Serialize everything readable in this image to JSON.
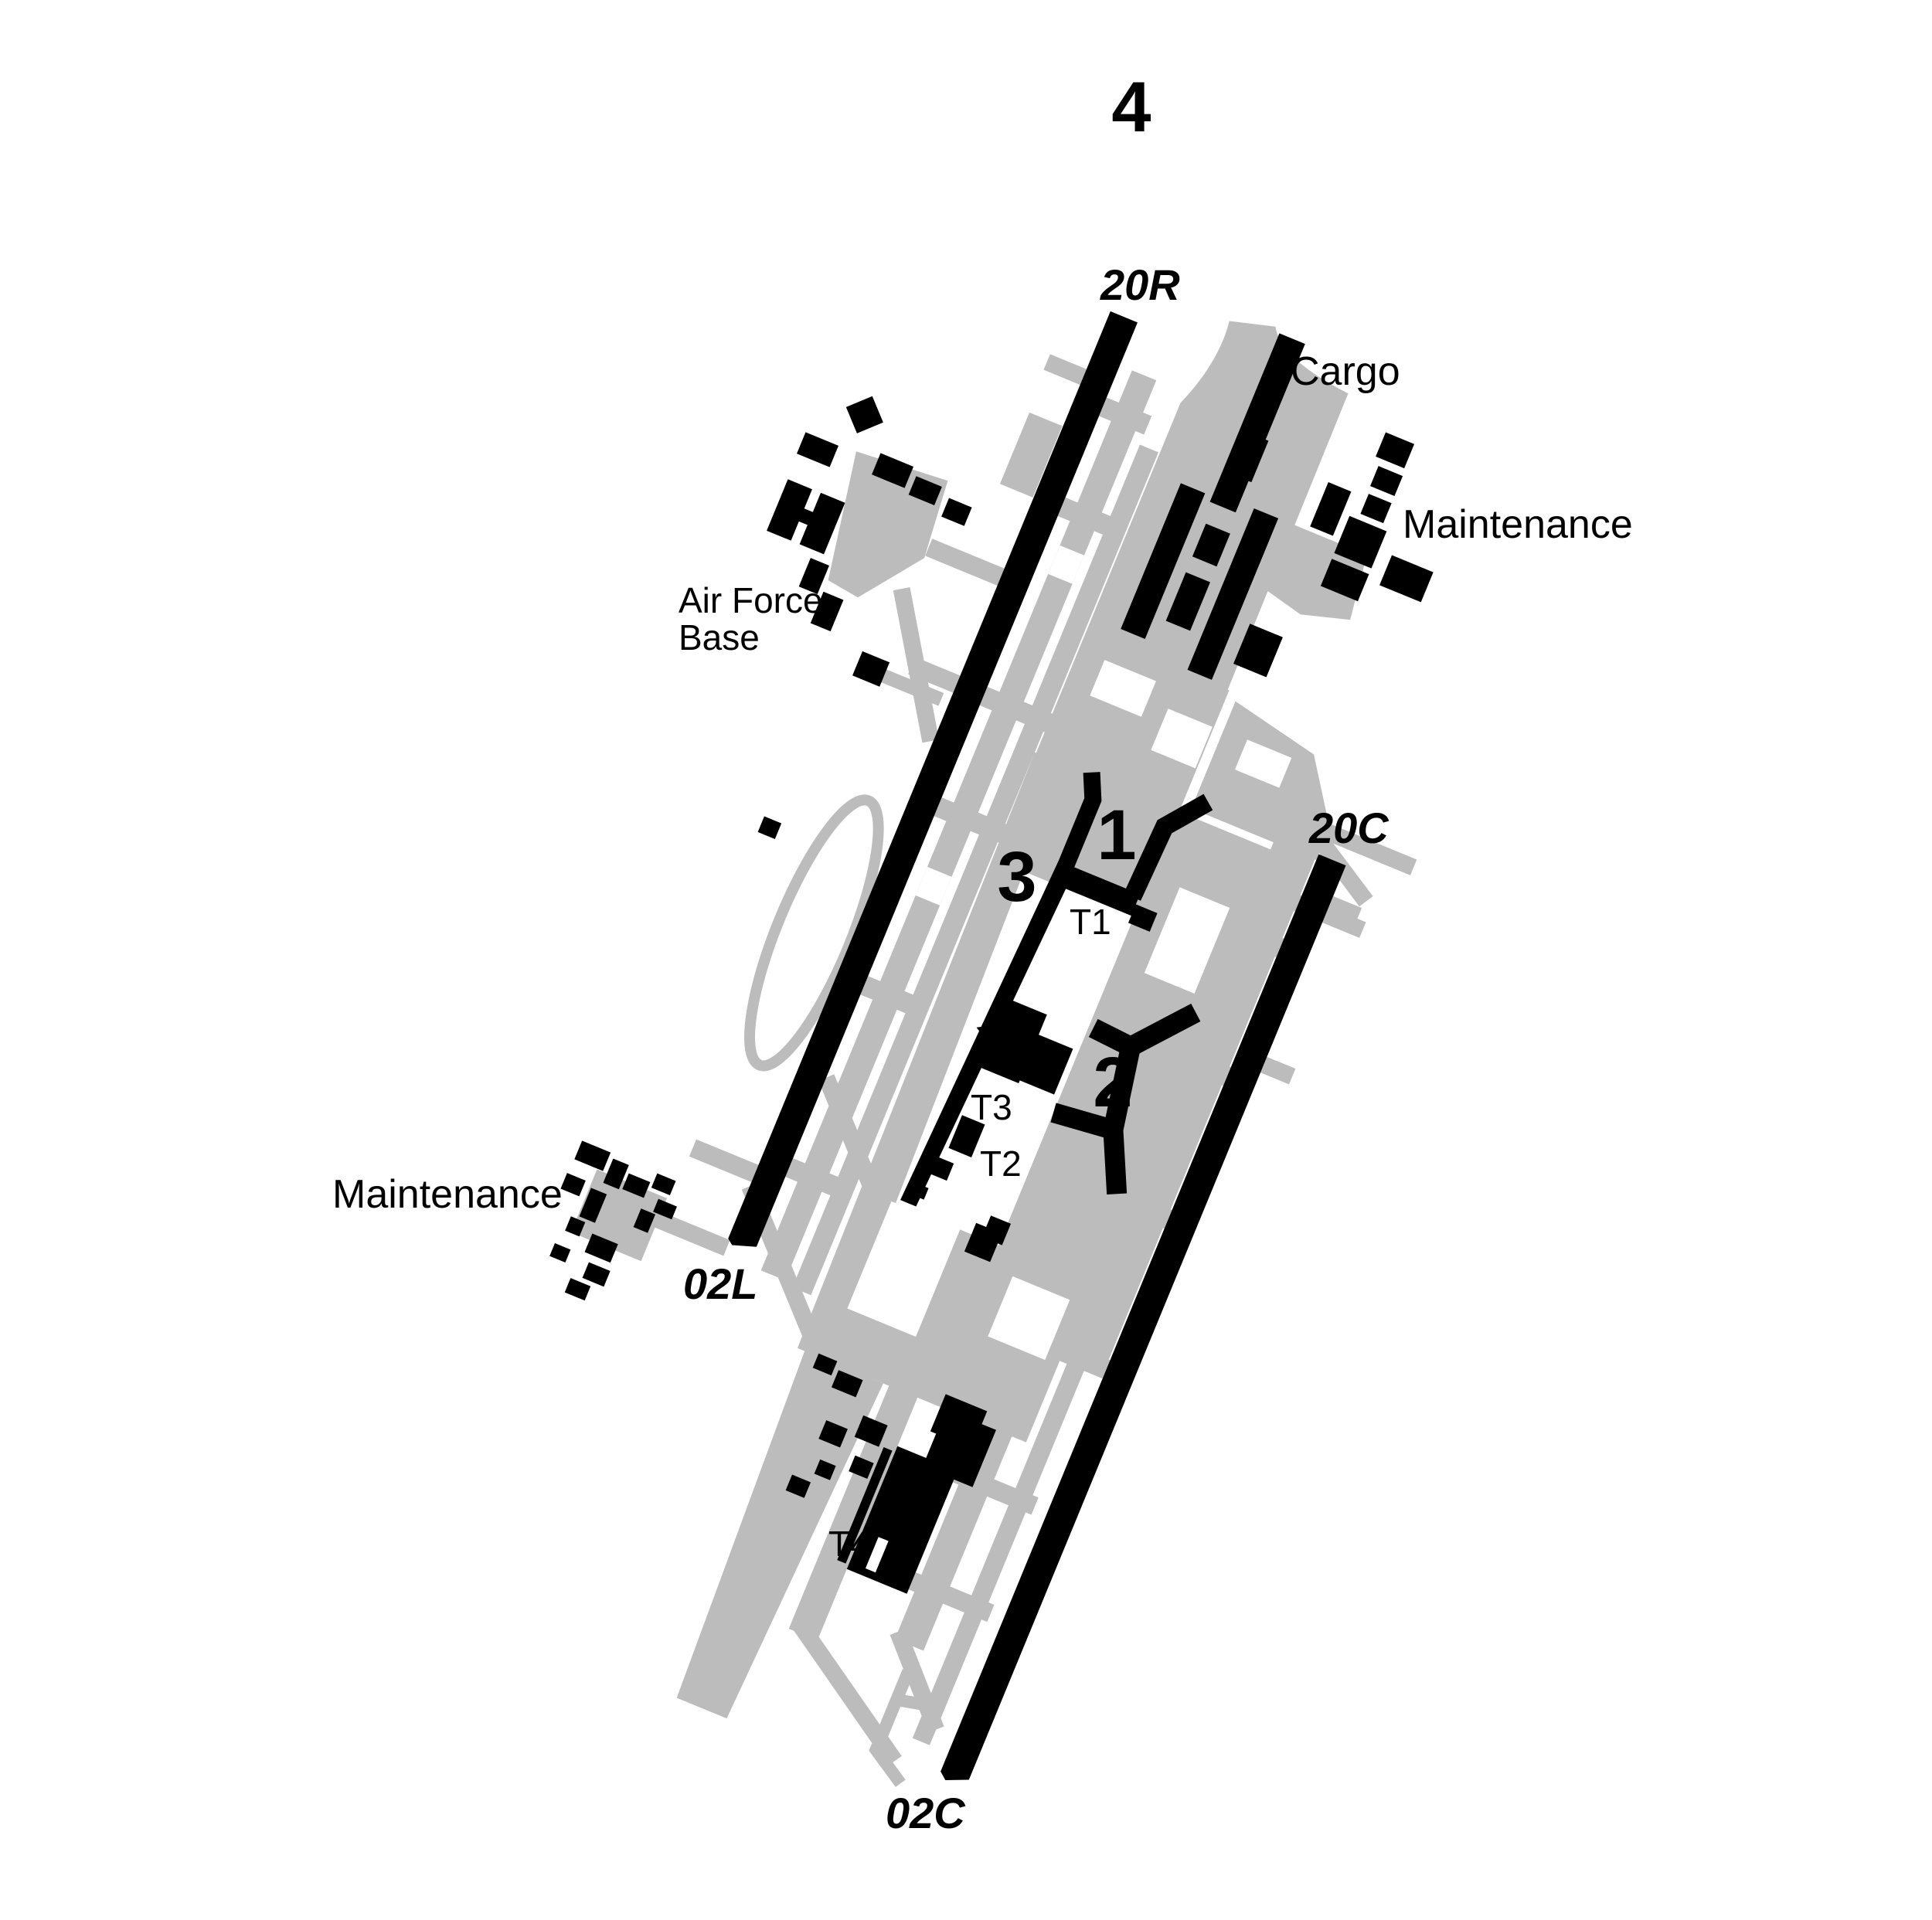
{
  "figure": {
    "number": "4"
  },
  "colors": {
    "black": "#000000",
    "taxiway_gray": "#bcbcbc",
    "background": "#ffffff"
  },
  "runways": [
    {
      "name": "20R/02L",
      "label_top": "20R",
      "label_bottom": "02L"
    },
    {
      "name": "20C/02C",
      "label_top": "20C",
      "label_bottom": "02C"
    }
  ],
  "areas": {
    "cargo": {
      "label": "Cargo"
    },
    "maintenance_northeast": {
      "label": "Maintenance"
    },
    "maintenance_west": {
      "label": "Maintenance"
    },
    "air_force_base": {
      "line1": "Air Force",
      "line2": "Base"
    }
  },
  "concourses": [
    {
      "label": "1"
    },
    {
      "label": "2"
    },
    {
      "label": "3"
    }
  ],
  "terminals": [
    {
      "label": "T1"
    },
    {
      "label": "T2"
    },
    {
      "label": "T3"
    },
    {
      "label": "T4"
    }
  ]
}
